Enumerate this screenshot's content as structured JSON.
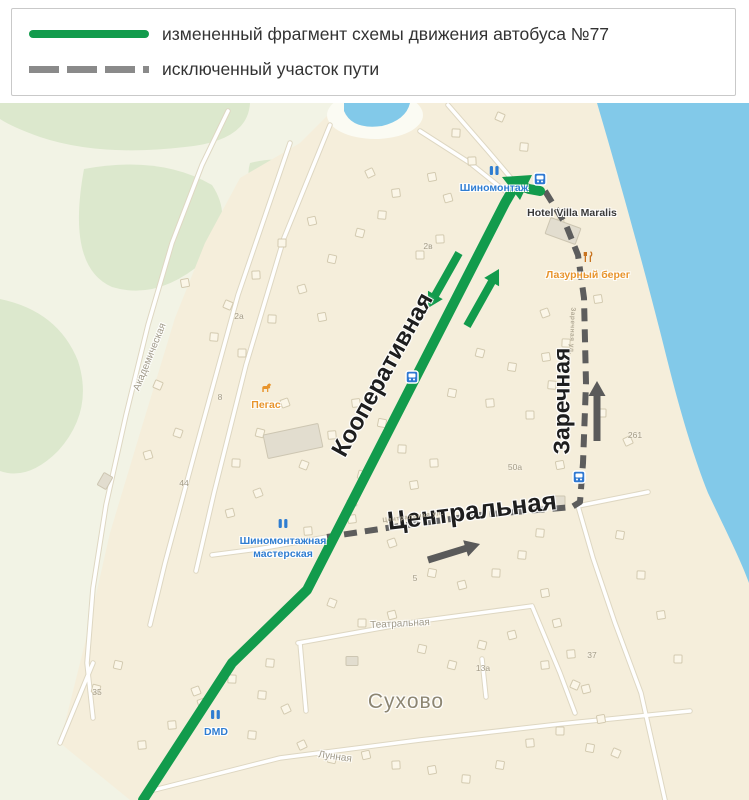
{
  "legend": {
    "items": [
      {
        "swatch": "solid-green",
        "color": "#129b4c",
        "label": "измененный фрагмент схемы движения автобуса №77"
      },
      {
        "swatch": "dashed-gray",
        "color": "#8a8a8a",
        "label": "исключенный участок пути"
      }
    ]
  },
  "map": {
    "colors": {
      "water": "#82c9e9",
      "land_outer": "#f2f3e5",
      "land_residential": "#f5eedb",
      "vegetation": "#dce8cd",
      "road": "#ffffff",
      "route_changed": "#129b4c",
      "route_excluded": "#5d5d5d",
      "poi_blue": "#2f7dd1",
      "poi_orange": "#e8942c",
      "bus_stop_blue": "#2e78d2"
    },
    "streets": {
      "kooperativnaya": "Кооперативная",
      "zarechnaya": "Заречная",
      "tsentralnaya": "Центральная",
      "akademicheskaya": "Академическая",
      "teatralnaya": "Театральная",
      "lunnaya": "Лунная",
      "tsentralnaya_small": "Центральная ул.",
      "zarechnaya_small": "Заречная ул."
    },
    "places": {
      "suhovo": "Сухово",
      "hotel": "Hotel Villa Maralis",
      "lazurny_bereg": "Лазурный берег",
      "pegas": "Пегас",
      "shinomontazh": "Шиномонтаж",
      "shinomontazhnaya_line1": "Шиномонтажная",
      "shinomontazhnaya_line2": "мастерская",
      "dmd": "DMD"
    },
    "house_numbers": [
      {
        "text": "2в",
        "x": 428,
        "y": 143
      },
      {
        "text": "2а",
        "x": 239,
        "y": 213
      },
      {
        "text": "8",
        "x": 220,
        "y": 294
      },
      {
        "text": "44",
        "x": 184,
        "y": 380
      },
      {
        "text": "50а",
        "x": 515,
        "y": 364
      },
      {
        "text": "5",
        "x": 415,
        "y": 475
      },
      {
        "text": "13а",
        "x": 483,
        "y": 565
      },
      {
        "text": "37",
        "x": 592,
        "y": 552
      },
      {
        "text": "35",
        "x": 97,
        "y": 589
      },
      {
        "text": "261",
        "x": 635,
        "y": 332
      }
    ],
    "routes": {
      "changed": {
        "name": "измененный фрагмент схемы движения автобуса №77",
        "color": "#129b4c",
        "width": 10,
        "points": [
          [
            143,
            697
          ],
          [
            232,
            560
          ],
          [
            307,
            487
          ],
          [
            505,
            100
          ],
          [
            516,
            81
          ],
          [
            529,
            86
          ],
          [
            540,
            88
          ]
        ],
        "apex": [
          [
            502,
            74
          ],
          [
            532,
            72
          ],
          [
            520,
            97
          ]
        ]
      },
      "excluded": {
        "name": "исключенный участок пути",
        "color": "#5d5d5d",
        "width": 6,
        "dash": "13 8",
        "points": [
          [
            545,
            88
          ],
          [
            566,
            122
          ],
          [
            578,
            152
          ],
          [
            584,
            195
          ],
          [
            586,
            280
          ],
          [
            583,
            360
          ],
          [
            580,
            399
          ],
          [
            572,
            404
          ],
          [
            480,
            412
          ],
          [
            400,
            423
          ],
          [
            327,
            434
          ]
        ]
      }
    },
    "arrows": [
      {
        "name": "route-direction-southwest",
        "color": "#129b4c",
        "width": 8,
        "from": [
          459,
          150
        ],
        "to": [
          428,
          205
        ]
      },
      {
        "name": "route-direction-northeast",
        "color": "#129b4c",
        "width": 8,
        "from": [
          467,
          223
        ],
        "to": [
          499,
          166
        ]
      },
      {
        "name": "excluded-direction-north",
        "color": "#5a5a5a",
        "width": 7,
        "from": [
          597,
          338
        ],
        "to": [
          597,
          278
        ]
      },
      {
        "name": "excluded-direction-east",
        "color": "#5a5a5a",
        "width": 7,
        "from": [
          428,
          457
        ],
        "to": [
          480,
          441
        ]
      }
    ],
    "bus_stops": [
      [
        540,
        76
      ],
      [
        579,
        374
      ],
      [
        412,
        274
      ]
    ],
    "buildings": [
      [
        500,
        14
      ],
      [
        456,
        30
      ],
      [
        524,
        44
      ],
      [
        472,
        58
      ],
      [
        432,
        74
      ],
      [
        396,
        90
      ],
      [
        448,
        95
      ],
      [
        370,
        70
      ],
      [
        560,
        120
      ],
      [
        598,
        196
      ],
      [
        545,
        210
      ],
      [
        312,
        118
      ],
      [
        282,
        140
      ],
      [
        332,
        156
      ],
      [
        256,
        172
      ],
      [
        302,
        186
      ],
      [
        228,
        202
      ],
      [
        272,
        216
      ],
      [
        242,
        250
      ],
      [
        214,
        234
      ],
      [
        322,
        214
      ],
      [
        360,
        130
      ],
      [
        382,
        112
      ],
      [
        440,
        136
      ],
      [
        420,
        152
      ],
      [
        185,
        180
      ],
      [
        480,
        250
      ],
      [
        512,
        264
      ],
      [
        546,
        254
      ],
      [
        452,
        290
      ],
      [
        490,
        300
      ],
      [
        530,
        312
      ],
      [
        566,
        240
      ],
      [
        552,
        282
      ],
      [
        602,
        310
      ],
      [
        628,
        338
      ],
      [
        560,
        362
      ],
      [
        356,
        300
      ],
      [
        382,
        320
      ],
      [
        332,
        332
      ],
      [
        402,
        346
      ],
      [
        304,
        362
      ],
      [
        362,
        372
      ],
      [
        414,
        382
      ],
      [
        434,
        360
      ],
      [
        285,
        300
      ],
      [
        260,
        330
      ],
      [
        236,
        360
      ],
      [
        158,
        282
      ],
      [
        178,
        330
      ],
      [
        148,
        352
      ],
      [
        258,
        390
      ],
      [
        230,
        410
      ],
      [
        352,
        400
      ],
      [
        392,
        440
      ],
      [
        432,
        470
      ],
      [
        462,
        482
      ],
      [
        496,
        470
      ],
      [
        522,
        452
      ],
      [
        352,
        416
      ],
      [
        308,
        428
      ],
      [
        540,
        430
      ],
      [
        332,
        500
      ],
      [
        362,
        520
      ],
      [
        392,
        512
      ],
      [
        422,
        546
      ],
      [
        452,
        562
      ],
      [
        482,
        542
      ],
      [
        512,
        532
      ],
      [
        545,
        562
      ],
      [
        575,
        582
      ],
      [
        545,
        490
      ],
      [
        557,
        520
      ],
      [
        571,
        551
      ],
      [
        586,
        586
      ],
      [
        601,
        616
      ],
      [
        616,
        650
      ],
      [
        620,
        432
      ],
      [
        641,
        472
      ],
      [
        661,
        512
      ],
      [
        678,
        556
      ],
      [
        232,
        576
      ],
      [
        262,
        592
      ],
      [
        286,
        606
      ],
      [
        202,
        600
      ],
      [
        172,
        622
      ],
      [
        142,
        642
      ],
      [
        252,
        632
      ],
      [
        302,
        642
      ],
      [
        332,
        656
      ],
      [
        366,
        652
      ],
      [
        396,
        662
      ],
      [
        432,
        667
      ],
      [
        118,
        562
      ],
      [
        96,
        586
      ],
      [
        466,
        676
      ],
      [
        500,
        662
      ],
      [
        270,
        560
      ],
      [
        196,
        588
      ],
      [
        530,
        640
      ],
      [
        560,
        628
      ],
      [
        590,
        645
      ]
    ],
    "gray_buildings": [
      [
        563,
        128,
        32,
        17,
        20
      ],
      [
        293,
        338,
        56,
        24,
        -12
      ],
      [
        558,
        398,
        14,
        10,
        0
      ],
      [
        352,
        558,
        12,
        9,
        0
      ],
      [
        105,
        378,
        14,
        10,
        -60
      ]
    ]
  }
}
